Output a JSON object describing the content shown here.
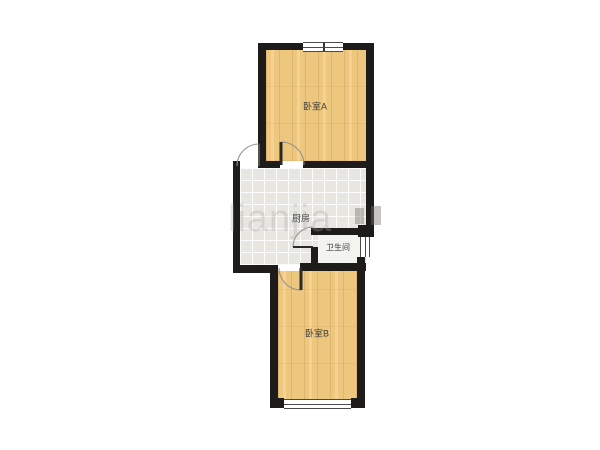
{
  "floorplan": {
    "rooms": {
      "bedroom_a": {
        "label": "卧室A"
      },
      "kitchen": {
        "label": "厨房"
      },
      "bathroom": {
        "label": "卫生间"
      },
      "bedroom_b": {
        "label": "卧室B"
      }
    },
    "watermark": {
      "text": "lianjia"
    }
  },
  "colors": {
    "wall": "#1d1c1a",
    "wood": "#eec77f",
    "tile": "#e7e6e1",
    "bath-floor": "#f3f3f0",
    "label": "#3c3b39",
    "door-arc": "#8f8e8c",
    "door-leaf": "#2a2927"
  }
}
